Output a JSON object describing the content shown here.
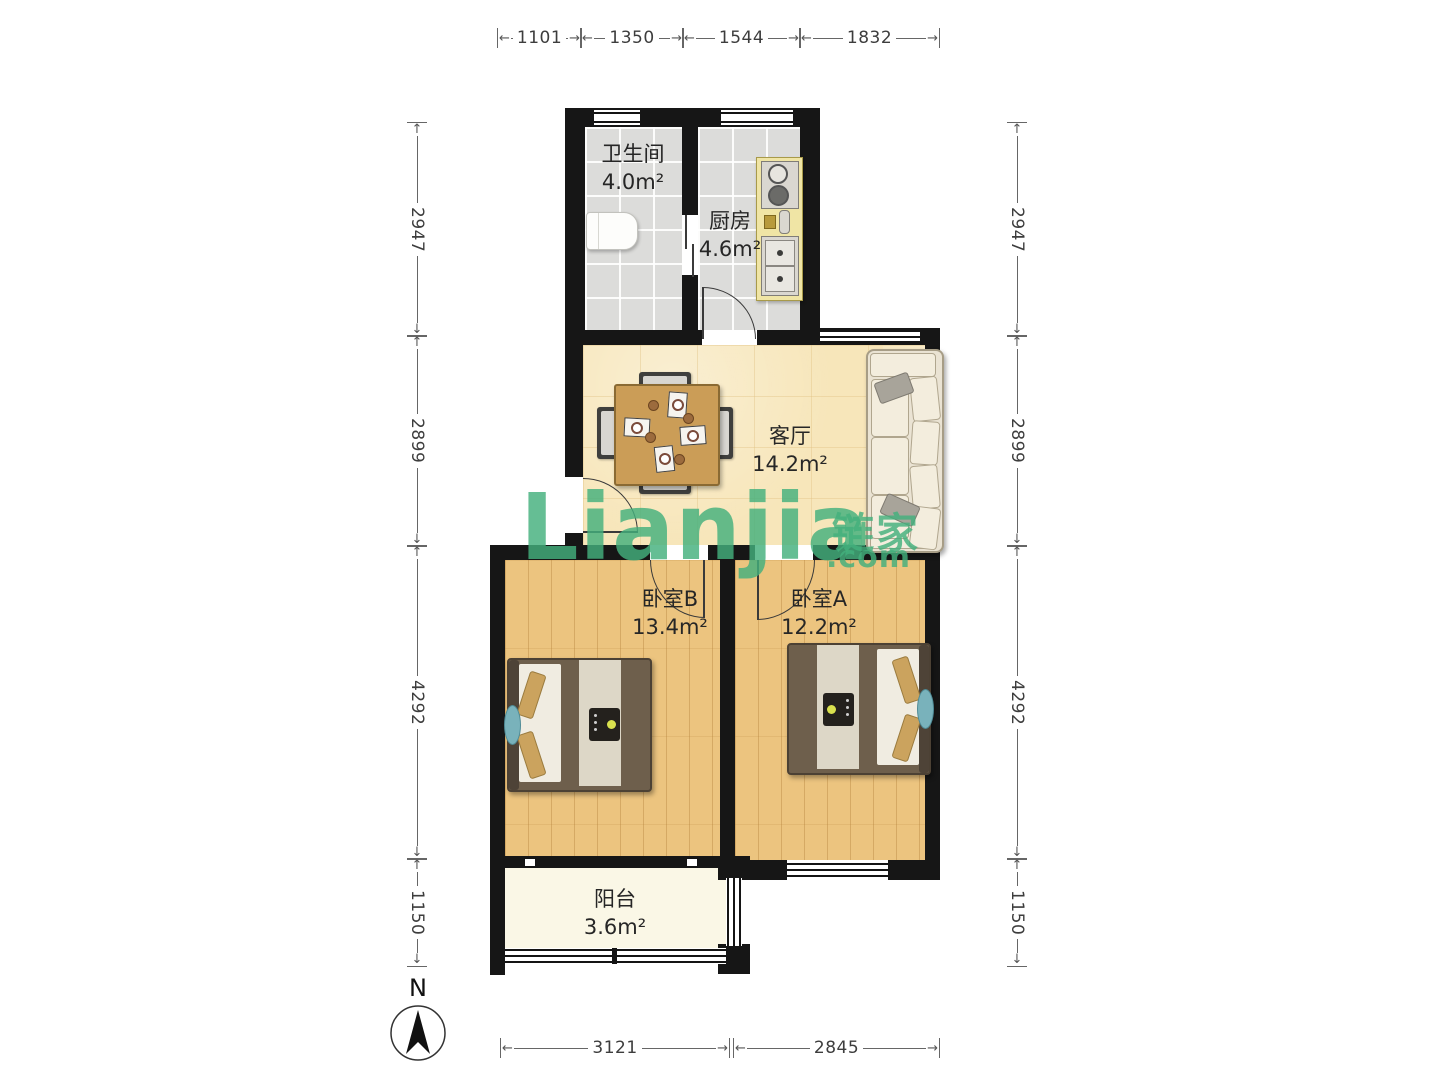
{
  "rooms": {
    "bathroom": {
      "name": "卫生间",
      "area": "4.0m²"
    },
    "kitchen": {
      "name": "厨房",
      "area": "4.6m²"
    },
    "living": {
      "name": "客厅",
      "area": "14.2m²"
    },
    "bedroom_b": {
      "name": "卧室B",
      "area": "13.4m²"
    },
    "bedroom_a": {
      "name": "卧室A",
      "area": "12.2m²"
    },
    "balcony": {
      "name": "阳台",
      "area": "3.6m²"
    }
  },
  "dimensions": {
    "top": [
      "1101",
      "1350",
      "1544",
      "1832"
    ],
    "bottom": [
      "3121",
      "2845"
    ],
    "left": [
      "2947",
      "2899",
      "4292",
      "1150"
    ],
    "right": [
      "2947",
      "2899",
      "4292",
      "1150"
    ]
  },
  "glyphs": {
    "arrow_left": "←",
    "arrow_right": "→",
    "arrow_up": "↑",
    "arrow_down": "↓"
  },
  "watermark": {
    "brand_latin": "Lianjia",
    "brand_cn": "链家",
    "suffix": ".com",
    "color": "#43b07c"
  },
  "compass": {
    "label": "N"
  },
  "colors": {
    "wall": "#161616",
    "tile_floor": "#dcdcda",
    "living_floor": "#f7e6ba",
    "wood_floor": "#ecc47f",
    "balcony_floor": "#faf7e6"
  }
}
